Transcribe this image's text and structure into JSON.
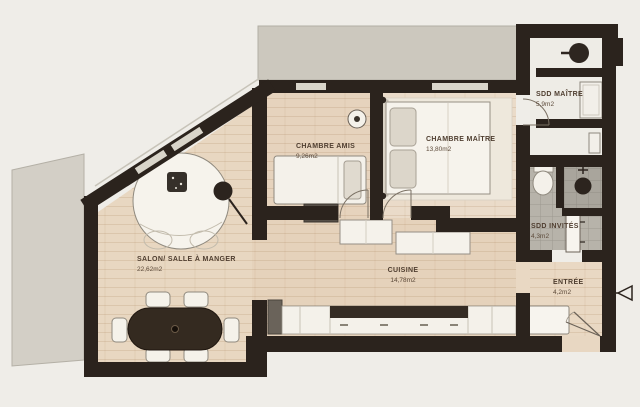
{
  "plan": {
    "title": "Apartment floor plan",
    "rooms": [
      {
        "id": "salon",
        "label": "SALON/ SALLE À MANGER",
        "area": "22,62m2"
      },
      {
        "id": "chambre-amis",
        "label": "CHAMBRE AMIS",
        "area": "9,26m2"
      },
      {
        "id": "chambre-maitre",
        "label": "CHAMBRE MAÎTRE",
        "area": "13,80m2"
      },
      {
        "id": "sdd-maitre",
        "label": "SDD MAÎTRE",
        "area": "5,9m2"
      },
      {
        "id": "sdd-invites",
        "label": "SDD INVITÉS",
        "area": "4,3m2"
      },
      {
        "id": "cuisine",
        "label": "CUISINE",
        "area": "14,78m2"
      },
      {
        "id": "entree",
        "label": "ENTRÉE",
        "area": "4,2m2"
      }
    ],
    "colors": {
      "background": "#efede8",
      "wall": "#2b231d",
      "wood_floor": "#e6d3bd",
      "wood_floor_master": "#eadbc9",
      "terrace": "#cdc9bf",
      "tile": "#b7b3aa",
      "tile_shower": "#a9a59c",
      "furniture_white": "#f5f2ea",
      "furniture_dark": "#342a20",
      "label_text": "#4f3e30"
    },
    "icons": {
      "entry_arrow": "open triangle pointing left at the entrance door",
      "floor_lamp": "black circle with stem in the salon",
      "shower_head": "black circle in guest shower",
      "basin": "black circle in master bathroom"
    }
  }
}
